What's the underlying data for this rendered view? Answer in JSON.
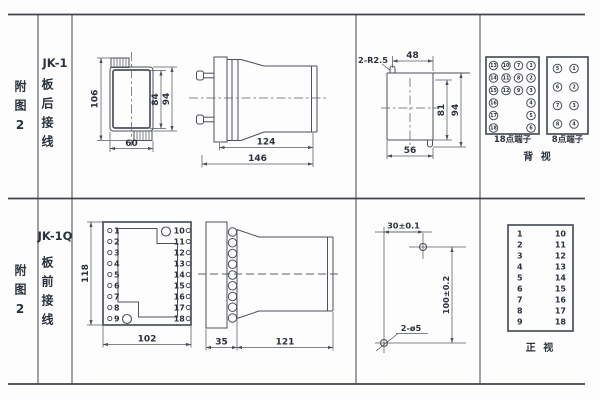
{
  "colors": {
    "line": "#4c505a",
    "grid": "#3f434c",
    "text": "#2b313d"
  },
  "top_row": {
    "figure_label": "附图2",
    "model": "JK-1",
    "wiring_label": "板后接线",
    "rear_view": {
      "dim_overall_height": "106",
      "dim_inner_height": "84",
      "dim_outer_height": "94",
      "dim_width": "60"
    },
    "side_view": {
      "dim_body_length": "124",
      "dim_overall_length": "146"
    },
    "cutout": {
      "corner_label": "2-R2.5",
      "dim_top_width": "48",
      "dim_inner_height": "81",
      "dim_overall_height": "94",
      "dim_bottom_width": "56"
    },
    "back_view": {
      "label_18": "18点端子",
      "label_8": "8点端子",
      "view_label": "背 视",
      "t18": [
        [
          "13",
          "10",
          "7",
          "1"
        ],
        [
          "14",
          "11",
          "8",
          "2"
        ],
        [
          "15",
          "12",
          "9",
          "3"
        ],
        [
          "16",
          "4"
        ],
        [
          "17",
          "5"
        ],
        [
          "18",
          "6"
        ]
      ],
      "t8": [
        [
          "5",
          "1"
        ],
        [
          "6",
          "2"
        ],
        [
          "7",
          "3"
        ],
        [
          "8",
          "4"
        ]
      ]
    }
  },
  "bottom_row": {
    "figure_label": "附图2",
    "model": "JK-1Q",
    "wiring_label": "板前接线",
    "front_view": {
      "dim_height": "118",
      "dim_width": "102",
      "left": [
        "1",
        "2",
        "3",
        "4",
        "5",
        "6",
        "7",
        "8",
        "9"
      ],
      "right": [
        "10",
        "11",
        "12",
        "13",
        "14",
        "15",
        "16",
        "17",
        "18"
      ]
    },
    "side_view": {
      "dim_panel": "35",
      "dim_body": "121"
    },
    "drill": {
      "dim_horizontal": "30±0.1",
      "dim_vertical": "100±0.2",
      "hole_label": "2-ø5"
    },
    "front_table": {
      "left": [
        "1",
        "2",
        "3",
        "4",
        "5",
        "6",
        "7",
        "8",
        "9"
      ],
      "right": [
        "10",
        "11",
        "12",
        "13",
        "14",
        "15",
        "16",
        "17",
        "18"
      ],
      "view_label": "正 视"
    }
  }
}
